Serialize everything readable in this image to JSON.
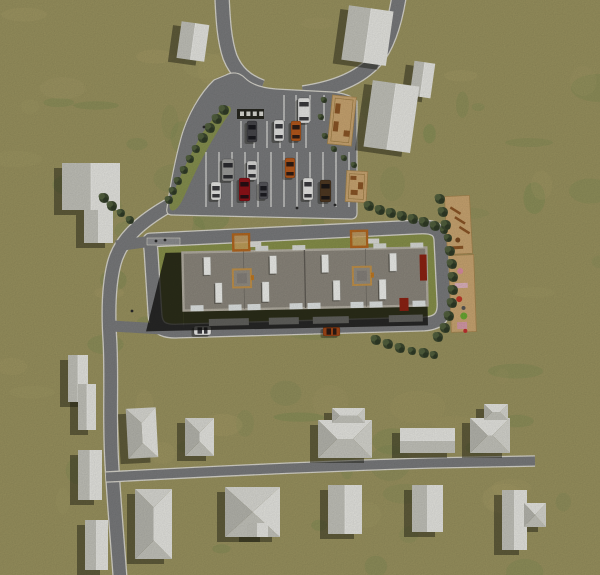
{
  "scene": {
    "width": 600,
    "height": 575,
    "title": "aerial-site-plan-render"
  },
  "palette": {
    "road": "#797a7c",
    "curb": "#d7d5cc",
    "stall": "#eaeae6",
    "plot": "#87904a",
    "median": "#86904f",
    "sidewalk": "#8d8e90",
    "roof": "#8b867c",
    "parapet": "#b2ada1",
    "roof_line": "#5f5b54",
    "roof_qline": "#6e6a62",
    "vent": "#edeeea",
    "facade": "#1d1d1a",
    "step": "#61615d",
    "canopy": "#b2661f",
    "canopy_fill": "#caa05c",
    "tower_trim": "#c0914a",
    "tower_fill": "#928d83",
    "tower_inner": "#85807a",
    "red": "#8c2212",
    "patio": "#c9a571",
    "patio_edge": "#a5854f",
    "bench": "#26261f",
    "wood": "#8a5526",
    "tree1": "#3c482f",
    "tree2": "#53623f",
    "tree3": "#2d3824",
    "house_lit": "#e6e6e1",
    "house_shade": "#c2c2ba",
    "house_top": "#d9d9d3",
    "house_bottom": "#c4c4bc",
    "house_dark": "#b5b5ad",
    "house_mid": "#d6d6cf",
    "ridge": "#f0f0ec",
    "shadow": "rgba(24,24,14,0.45)",
    "bshadow": "rgba(12,12,9,0.75)",
    "figure": "#2a2a2a"
  },
  "grass": {
    "base": "#99925f",
    "green": "#74894e",
    "tan": "#a99e69",
    "n_green": 55,
    "n_tan": 38
  },
  "roads": [
    {
      "name": "road-north-west",
      "d": "M222,-3 C223,18 224,40 230,57 C236,72 246,81 262,87",
      "w": 13
    },
    {
      "name": "road-north-east",
      "d": "M399,-3 C395,22 388,46 375,61 C358,80 330,89 303,93",
      "w": 13
    },
    {
      "name": "road-west",
      "d": "M168,206 C140,222 120,240 114,264 C109,284 108,312 110,342 C112,382 109,422 112,466 C114,502 117,536 120,577",
      "w": 12.5
    },
    {
      "name": "road-south-east",
      "d": "M106,477 C200,472 330,466 430,463 L535,461",
      "w": 9
    }
  ],
  "ring_road": {
    "name": "ring-road",
    "d": "M150,240 L418,227 C436,226 441,231 441,242 L444,302 C445,318 438,323 424,324 L178,331 C162,332 156,327 155,315 L151,251 Q150,241 150,240 Z",
    "w": 12.5,
    "stubs": [
      {
        "d": "M152,241 L116,246",
        "w": 11
      },
      {
        "d": "M162,329 L112,326",
        "w": 11
      }
    ]
  },
  "parking": {
    "outline": "M214,80 C200,93 187,116 181,138 C175,160 170,187 167,208 C166,213 168,215 172,215 L351,219 C355,219 357,217 357,213 L357,101 C352,96 344,93 332,92 L276,89 C262,88 251,84 245,78 C239,72 232,72 226,75 Z",
    "median": "M225,107 C216,114 207,125 199,139 C190,155 180,176 173,194 C170,201 168,207 171,210 C175,212 179,207 183,199 C191,181 200,162 209,146 C217,132 224,121 230,113 C233,108 229,104 225,107 Z",
    "stall_rows": [
      {
        "y1": 95,
        "y2": 121,
        "xs": [
          284,
          296,
          310,
          324
        ]
      },
      {
        "y1": 121,
        "y2": 148,
        "xs": [
          241,
          254,
          267,
          280,
          293,
          306
        ]
      },
      {
        "y1": 152,
        "y2": 207,
        "xs": [
          206,
          219,
          232,
          245,
          258,
          271,
          284,
          297,
          310,
          323,
          336,
          349
        ]
      }
    ],
    "bench_row": {
      "x": 237,
      "y": 109,
      "w": 27,
      "h": 10,
      "slats": 4
    }
  },
  "sidewalk": [
    147,
    238,
    33,
    7
  ],
  "building": {
    "rot": [
      -1.2,
      305,
      280
    ],
    "shadow_left": [
      [
        183,
        250
      ],
      [
        166,
        250
      ],
      [
        145,
        328
      ],
      [
        183,
        328
      ]
    ],
    "band": [
      183,
      306,
      244,
      22
    ],
    "steps": [
      [
        208,
        317,
        40,
        7
      ],
      [
        268,
        317,
        30,
        7
      ],
      [
        312,
        317,
        36,
        7
      ],
      [
        388,
        317,
        34,
        7
      ]
    ],
    "roof": [
      183,
      250,
      244,
      58
    ],
    "mid_x": 305,
    "q_x": [
      244,
      366
    ],
    "vents_top": {
      "y": 255,
      "h": 18,
      "w": 7,
      "xs": [
        204,
        270,
        322,
        390
      ]
    },
    "vents_bottom": {
      "y": 281,
      "h": 20,
      "w": 7,
      "xs": [
        215,
        262,
        333,
        379
      ]
    },
    "north_white": {
      "y": 245,
      "h": 5,
      "w": 13,
      "xs": [
        256,
        293,
        374,
        411
      ]
    },
    "south_white": {
      "y": 303,
      "h": 6,
      "w": 13,
      "xs": [
        190,
        228,
        247,
        289,
        307,
        350,
        369,
        412
      ]
    },
    "towers": [
      [
        233,
        268
      ],
      [
        353,
        268
      ]
    ],
    "tower_size": 18,
    "canopies": [
      [
        234,
        233
      ],
      [
        352,
        232
      ]
    ],
    "canopy_size": 16,
    "reds": [
      [
        420,
        257,
        7,
        26
      ],
      [
        399,
        300,
        9,
        13
      ]
    ]
  },
  "patios": [
    {
      "name": "patio-north",
      "x": 330,
      "y": 96,
      "w": 24,
      "h": 49,
      "rot": [
        6,
        342,
        120
      ],
      "items": [
        [
          334,
          104,
          5,
          10
        ],
        [
          334,
          122,
          5,
          10
        ],
        [
          345,
          130,
          6,
          6
        ]
      ]
    },
    {
      "name": "patio-mid",
      "x": 346,
      "y": 171,
      "w": 21,
      "h": 31,
      "rot": [
        3,
        356,
        186
      ],
      "items": [
        [
          350,
          176,
          6,
          4
        ],
        [
          358,
          182,
          5,
          7
        ],
        [
          351,
          190,
          7,
          5
        ]
      ]
    }
  ],
  "playgrounds": [
    {
      "name": "playground-north",
      "x": 446,
      "y": 196,
      "w": 25,
      "h": 58,
      "rot": [
        -3,
        458,
        225
      ],
      "items": [
        [
          "bar",
          452,
          206
        ],
        [
          "bar",
          456,
          216
        ],
        [
          "bar",
          460,
          226
        ],
        [
          "dot",
          457,
          240,
          2.5,
          "#7a4a20"
        ],
        [
          "rect",
          451,
          246,
          11,
          3,
          "#8a5526"
        ]
      ]
    },
    {
      "name": "playground-east",
      "x": 450,
      "y": 255,
      "w": 25,
      "h": 77,
      "rot": [
        -2,
        462,
        293
      ],
      "items": [
        [
          "dot",
          461,
          271,
          3,
          "#d98ca0"
        ],
        [
          "rect",
          455,
          283,
          13,
          5,
          "#ddb2bd"
        ],
        [
          "dot",
          459,
          299,
          3,
          "#c03828"
        ],
        [
          "dot",
          463,
          308,
          2,
          "#555555"
        ],
        [
          "dot",
          463,
          316,
          3.5,
          "#6aa832"
        ],
        [
          "rect",
          456,
          322,
          10,
          7,
          "#d49aa8"
        ],
        [
          "dot",
          464,
          331,
          2,
          "#c03030"
        ]
      ]
    }
  ],
  "houses": [
    {
      "id": "house-nw-small",
      "rot": [
        8,
        193,
        41
      ],
      "parts": [
        [
          "gv",
          179,
          23,
          28,
          37
        ]
      ]
    },
    {
      "id": "house-n-large",
      "rot": [
        8,
        367,
        35
      ],
      "parts": [
        [
          "gv",
          345,
          8,
          45,
          55
        ]
      ]
    },
    {
      "id": "house-ne-small",
      "rot": [
        8,
        422,
        79
      ],
      "parts": [
        [
          "gv",
          412,
          62,
          21,
          35
        ]
      ]
    },
    {
      "id": "house-ne-large",
      "rot": [
        8,
        391,
        116
      ],
      "parts": [
        [
          "gv",
          368,
          83,
          47,
          67
        ]
      ]
    },
    {
      "id": "house-west",
      "parts": [
        [
          "gv",
          62,
          163,
          58,
          47
        ],
        [
          "gv",
          84,
          210,
          29,
          33
        ]
      ]
    },
    {
      "id": "house-sw-pair",
      "parts": [
        [
          "gv",
          68,
          355,
          20,
          47
        ],
        [
          "gv",
          78,
          384,
          18,
          46
        ]
      ]
    },
    {
      "id": "house-sw-2",
      "parts": [
        [
          "gv",
          78,
          450,
          24,
          50
        ]
      ]
    },
    {
      "id": "house-sw-3",
      "parts": [
        [
          "gv",
          85,
          520,
          23,
          50
        ]
      ]
    },
    {
      "id": "house-s-1",
      "rot": [
        -3,
        142,
        433
      ],
      "parts": [
        [
          "hv",
          127,
          408,
          30,
          50
        ]
      ]
    },
    {
      "id": "house-s-2",
      "parts": [
        [
          "hv",
          185,
          418,
          29,
          38
        ]
      ]
    },
    {
      "id": "house-s-3",
      "parts": [
        [
          "hv",
          135,
          489,
          37,
          70
        ]
      ]
    },
    {
      "id": "house-s-4",
      "parts": [
        [
          "hv",
          225,
          487,
          55,
          50
        ],
        [
          "gv",
          247,
          523,
          21,
          14
        ]
      ]
    },
    {
      "id": "house-s-5",
      "parts": [
        [
          "gv",
          328,
          485,
          34,
          49
        ]
      ]
    },
    {
      "id": "house-s-6",
      "parts": [
        [
          "hh",
          318,
          420,
          54,
          38
        ],
        [
          "hh",
          332,
          408,
          33,
          15
        ]
      ]
    },
    {
      "id": "house-s-7",
      "parts": [
        [
          "gh",
          400,
          428,
          55,
          25
        ]
      ]
    },
    {
      "id": "house-s-8",
      "parts": [
        [
          "hh",
          470,
          418,
          40,
          35
        ],
        [
          "hh",
          484,
          404,
          24,
          16
        ]
      ]
    },
    {
      "id": "house-s-9",
      "parts": [
        [
          "gv",
          412,
          485,
          31,
          47
        ]
      ]
    },
    {
      "id": "house-s-10",
      "parts": [
        [
          "gv",
          502,
          490,
          25,
          60
        ],
        [
          "hh",
          524,
          503,
          22,
          24
        ]
      ]
    }
  ],
  "cars": [
    {
      "id": "van-white",
      "x": 298,
      "y": 98,
      "w": 12,
      "h": 25,
      "c": "#e4e4e2",
      "o": "v"
    },
    {
      "id": "car-dark",
      "x": 247,
      "y": 121,
      "w": 10,
      "h": 21,
      "c": "#46464a",
      "o": "v"
    },
    {
      "id": "car-white-1",
      "x": 274,
      "y": 120,
      "w": 10,
      "h": 21,
      "c": "#e2e2e0",
      "o": "v"
    },
    {
      "id": "car-orange-1",
      "x": 291,
      "y": 121,
      "w": 10,
      "h": 20,
      "c": "#b4581c",
      "o": "v"
    },
    {
      "id": "van-gray",
      "x": 222,
      "y": 159,
      "w": 12,
      "h": 22,
      "c": "#9c9c9a",
      "o": "v"
    },
    {
      "id": "car-silver",
      "x": 247,
      "y": 161,
      "w": 10,
      "h": 19,
      "c": "#d8d8d6",
      "o": "v"
    },
    {
      "id": "car-orange-2",
      "x": 285,
      "y": 158,
      "w": 10,
      "h": 20,
      "c": "#b4581c",
      "o": "v"
    },
    {
      "id": "car-white-2",
      "x": 211,
      "y": 182,
      "w": 10,
      "h": 18,
      "c": "#e6e6e4",
      "o": "v"
    },
    {
      "id": "car-red",
      "x": 239,
      "y": 178,
      "w": 11,
      "h": 23,
      "c": "#8e1218",
      "o": "v"
    },
    {
      "id": "car-gray-2",
      "x": 259,
      "y": 182,
      "w": 9,
      "h": 17,
      "c": "#55555a",
      "o": "v"
    },
    {
      "id": "car-white-3",
      "x": 303,
      "y": 178,
      "w": 10,
      "h": 22,
      "c": "#e6e6e4",
      "o": "v"
    },
    {
      "id": "car-brown",
      "x": 320,
      "y": 180,
      "w": 11,
      "h": 22,
      "c": "#4e3822",
      "o": "v"
    },
    {
      "id": "car-road-white",
      "x": 194,
      "y": 326,
      "w": 17,
      "h": 9,
      "c": "#ececea",
      "o": "h"
    },
    {
      "id": "car-road-orange",
      "x": 323,
      "y": 327,
      "w": 17,
      "h": 9,
      "c": "#a04616",
      "o": "h"
    }
  ],
  "trees": [
    [
      224,
      110,
      5
    ],
    [
      217,
      119,
      5
    ],
    [
      210,
      128,
      5
    ],
    [
      203,
      138,
      5
    ],
    [
      196,
      149,
      4
    ],
    [
      190,
      159,
      4
    ],
    [
      184,
      170,
      4
    ],
    [
      178,
      181,
      4
    ],
    [
      173,
      191,
      4
    ],
    [
      169,
      200,
      4
    ],
    [
      104,
      198,
      5
    ],
    [
      112,
      206,
      5
    ],
    [
      121,
      213,
      4
    ],
    [
      130,
      220,
      4
    ],
    [
      369,
      206,
      5
    ],
    [
      380,
      210,
      5
    ],
    [
      391,
      213,
      5
    ],
    [
      402,
      216,
      5
    ],
    [
      413,
      219,
      5
    ],
    [
      424,
      222,
      5
    ],
    [
      435,
      226,
      5
    ],
    [
      444,
      230,
      4
    ],
    [
      440,
      199,
      5
    ],
    [
      443,
      212,
      5
    ],
    [
      446,
      225,
      5
    ],
    [
      448,
      238,
      4
    ],
    [
      450,
      251,
      5
    ],
    [
      452,
      264,
      5
    ],
    [
      453,
      277,
      5
    ],
    [
      453,
      290,
      5
    ],
    [
      452,
      303,
      5
    ],
    [
      449,
      316,
      5
    ],
    [
      445,
      328,
      5
    ],
    [
      438,
      337,
      5
    ],
    [
      376,
      340,
      5
    ],
    [
      388,
      344,
      5
    ],
    [
      400,
      348,
      5
    ],
    [
      412,
      351,
      4
    ],
    [
      424,
      353,
      5
    ],
    [
      434,
      355,
      4
    ],
    [
      324,
      100,
      3
    ],
    [
      321,
      117,
      3
    ],
    [
      325,
      136,
      3
    ],
    [
      334,
      149,
      3
    ],
    [
      344,
      158,
      3
    ],
    [
      354,
      165,
      3
    ]
  ],
  "figures": [
    [
      156,
      241
    ],
    [
      165,
      240
    ],
    [
      204,
      127
    ],
    [
      297,
      208
    ],
    [
      335,
      205
    ],
    [
      132,
      311
    ]
  ]
}
